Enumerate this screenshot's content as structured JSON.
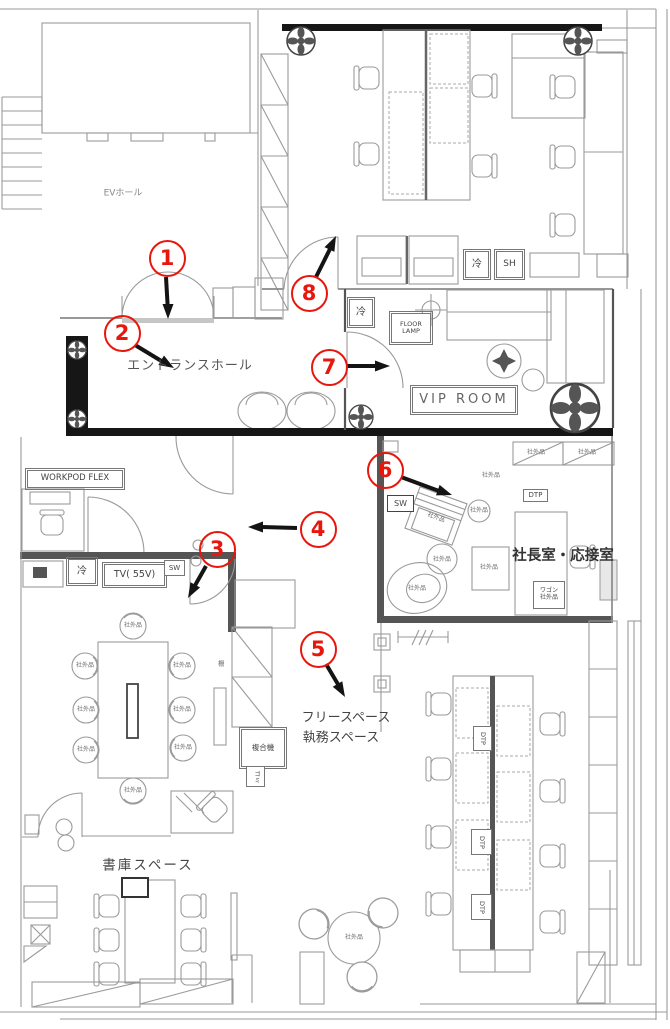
{
  "colors": {
    "annotation_red": "#e8160c",
    "wall_black": "#161616",
    "wall_dark": "#555555",
    "line_gray": "#9a9a9a"
  },
  "rooms": {
    "ev_hall": "EVホール",
    "entrance_hall": "エントランスホール",
    "vip_room": "VIP ROOM",
    "president_room": "社長室・応接室",
    "free_space_1": "フリースペース",
    "free_space_2": "執務スペース",
    "library": "書庫スペース"
  },
  "labels": {
    "workpod": "WORKPOD FLEX",
    "floor_lamp_1": "FLOOR",
    "floor_lamp_2": "LAMP",
    "tv": "TV( 55V)",
    "sw": "SW",
    "cold": "冷",
    "sh": "SH",
    "dtp": "DTP",
    "mfp": "複合機",
    "trash": "ゴミ",
    "wagon_1": "ワゴン",
    "wagon_2": "社外品",
    "shelf": "棚",
    "gaihin": "社外品"
  },
  "annotations": [
    {
      "num": "1"
    },
    {
      "num": "2"
    },
    {
      "num": "3"
    },
    {
      "num": "4"
    },
    {
      "num": "5"
    },
    {
      "num": "6"
    },
    {
      "num": "7"
    },
    {
      "num": "8"
    }
  ]
}
